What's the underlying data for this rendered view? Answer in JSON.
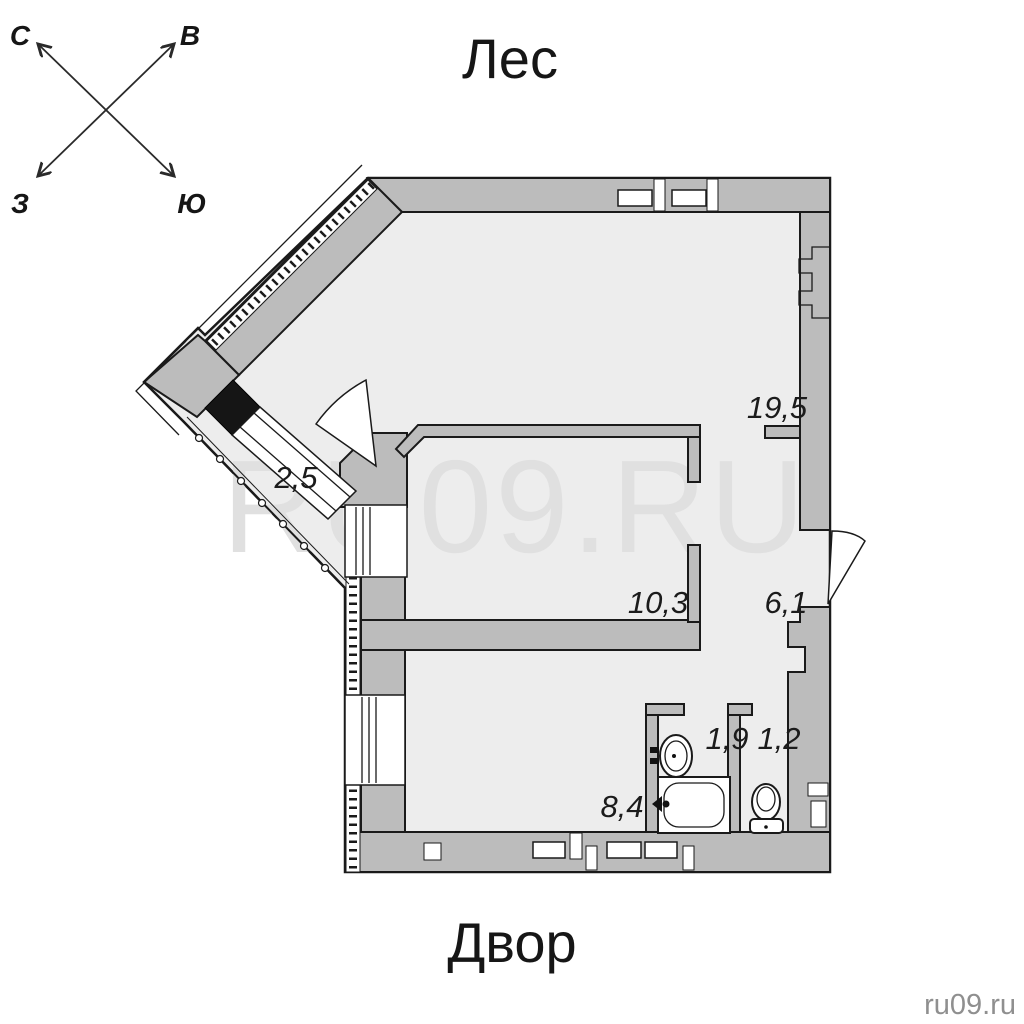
{
  "window": {
    "background": "#ffffff"
  },
  "compass": {
    "north": "С",
    "east": "В",
    "west": "З",
    "south": "Ю"
  },
  "surroundings": {
    "top": "Лес",
    "bottom": "Двор"
  },
  "watermark": "RU09.RU",
  "credit": "ru09.ru",
  "floor_plan": {
    "room_areas": [
      "19,5",
      "2,5",
      "10,3",
      "6,1",
      "1,9",
      "1,2",
      "8,4"
    ],
    "colors": {
      "wall": "#bcbcbc",
      "floor": "#ededed",
      "outline": "#1a1a1a",
      "window_fill": "#ffffff",
      "watermark": "#e0e0e0"
    }
  }
}
